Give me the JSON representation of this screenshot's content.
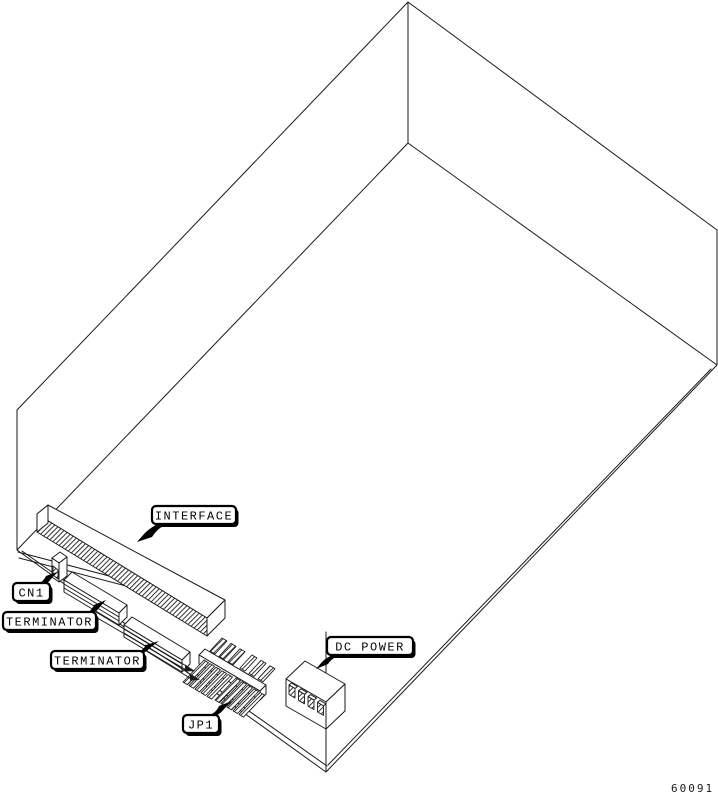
{
  "callouts": {
    "interface": {
      "text": "INTERFACE"
    },
    "cn1": {
      "text": "CN1"
    },
    "terminator_upper": {
      "text": "TERMINATOR"
    },
    "terminator_lower": {
      "text": "TERMINATOR"
    },
    "jp1": {
      "text": "JP1"
    },
    "dc_power": {
      "text": "DC POWER"
    }
  },
  "figure_number": "60091",
  "colors": {
    "background": "#ffffff",
    "line": "#1a1a1a",
    "callout_fill": "#ffffff",
    "callout_border": "#000000"
  }
}
